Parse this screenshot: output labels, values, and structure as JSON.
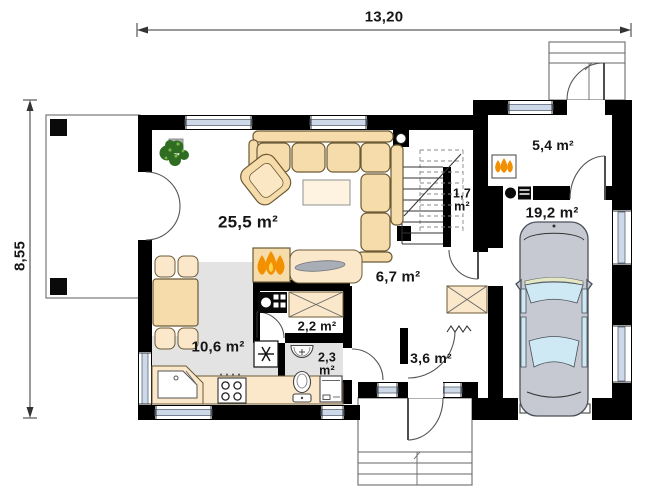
{
  "plan": {
    "dimensions": {
      "width": "13,20",
      "height": "8,55"
    },
    "rooms": {
      "living": {
        "label": "25,5 m²"
      },
      "kitchen": {
        "label": "10,6 m²"
      },
      "hall": {
        "label": "6,7 m²"
      },
      "pantry": {
        "label": "2,2 m²"
      },
      "bathroom": {
        "label_line1": "2,3",
        "label_line2": "m²"
      },
      "vestibule": {
        "label": "3,6 m²"
      },
      "stairs": {
        "label_line1": "1,7",
        "label_line2": "m²"
      },
      "utility": {
        "label": "5,4 m²"
      },
      "garage": {
        "label": "19,2 m²"
      }
    },
    "icons": {
      "fireplace": "flames-icon",
      "boiler": "flames-icon",
      "fridge": "snowflake-star-icon",
      "coat_hooks": "zigzag-icon",
      "plant": "foliage-icon",
      "car": "car-top-view-icon",
      "stairs_direction": "diagonal-line-icon"
    },
    "colors": {
      "wall": "#000000",
      "furniture": "#f7dcab",
      "counter": "#fbe8cb",
      "floor": "#e3e3e3",
      "window_blue": "#cdd9e8",
      "glass": "#cfe9f4",
      "car": "#c6c9d2",
      "flame": "#f29000",
      "flame_core": "#ffd24d",
      "plant": "#2f6d22"
    }
  }
}
